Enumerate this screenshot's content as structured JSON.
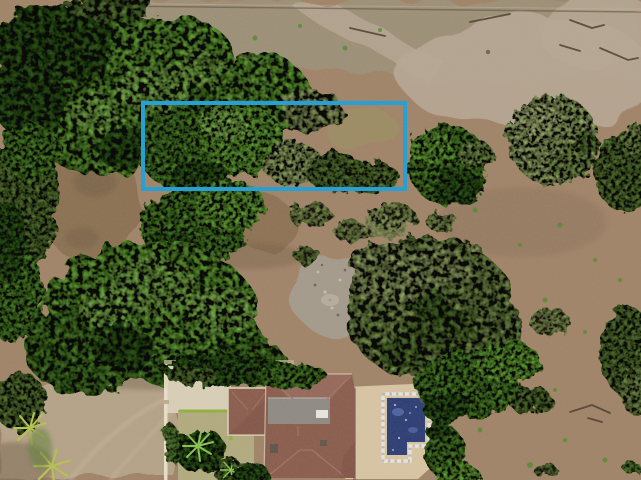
{
  "image": {
    "type": "aerial-drone-photo",
    "subject": "vacant land parcel outlined in blue beside trees, dry terrain and a house with swimming pool",
    "width": 641,
    "height": 480
  },
  "annotation": {
    "lot_outline": {
      "shape": "rectangle",
      "x": 143,
      "y": 103,
      "width": 262,
      "height": 86,
      "stroke_width": 4
    }
  },
  "colors": {
    "boundary_blue": "#1f9ed6",
    "dirt_base": "#a08368",
    "dirt_field": "#9c8f77",
    "dirt_pale": "#b7a794",
    "dirt_clearing": "#8b7051",
    "dirt_road": "#b4a287",
    "dirt_rock_gray": "#a39a8b",
    "dirt_moss": "#98955f",
    "canopy_dark": "#33611c",
    "canopy_mid": "#4f8a2b",
    "canopy_bright": "#69ae39",
    "canopy_light": "#85c24f",
    "canopy_sage": "#7f9d4f",
    "canopy_sage_light": "#9db369",
    "canopy_olive": "#5c7f35",
    "canopy_pale": "#b9cb83",
    "palm_yellow": "#b5c24e",
    "roof_brown": "#8a5c4d",
    "roof_dark": "#6f4539",
    "roof_light": "#a1766a",
    "roof_gray": "#8d8a83",
    "fascia_cream": "#d9cfb8",
    "deck_cream": "#d7c5a3",
    "lawn_tan": "#b2aa7e",
    "hedge_lime": "#8faf3f",
    "pool_navy": "#2b3c74",
    "pool_light": "#5e77b8",
    "tile_white": "#eae5d8",
    "tile_grout": "#9aa0b0",
    "wall_white": "#ece2ca",
    "wall_post": "#b9ad92",
    "ac_white": "#e8e6e0",
    "vent_dark": "#55524a",
    "branch_dark": "#4a3b2b",
    "terracotta": "#9b6b54",
    "track_light": "#c4b294",
    "shadow_soil": "#6e5c44",
    "speck_dark": "#6f6353",
    "speck_light": "#c6bcab",
    "fence_dark": "#6b5c48",
    "dead_branch": "#9a8f7c"
  },
  "objects": [
    "lot-boundary-annotation",
    "tree-canopy",
    "dirt-terrain",
    "dry-field",
    "dirt-road",
    "fence-line",
    "house-roof",
    "flat-roof-section",
    "swimming-pool",
    "pool-deck",
    "garden-lawn",
    "garden-wall",
    "palm-trees",
    "shrubs",
    "rocky-patch",
    "fallen-branches"
  ]
}
